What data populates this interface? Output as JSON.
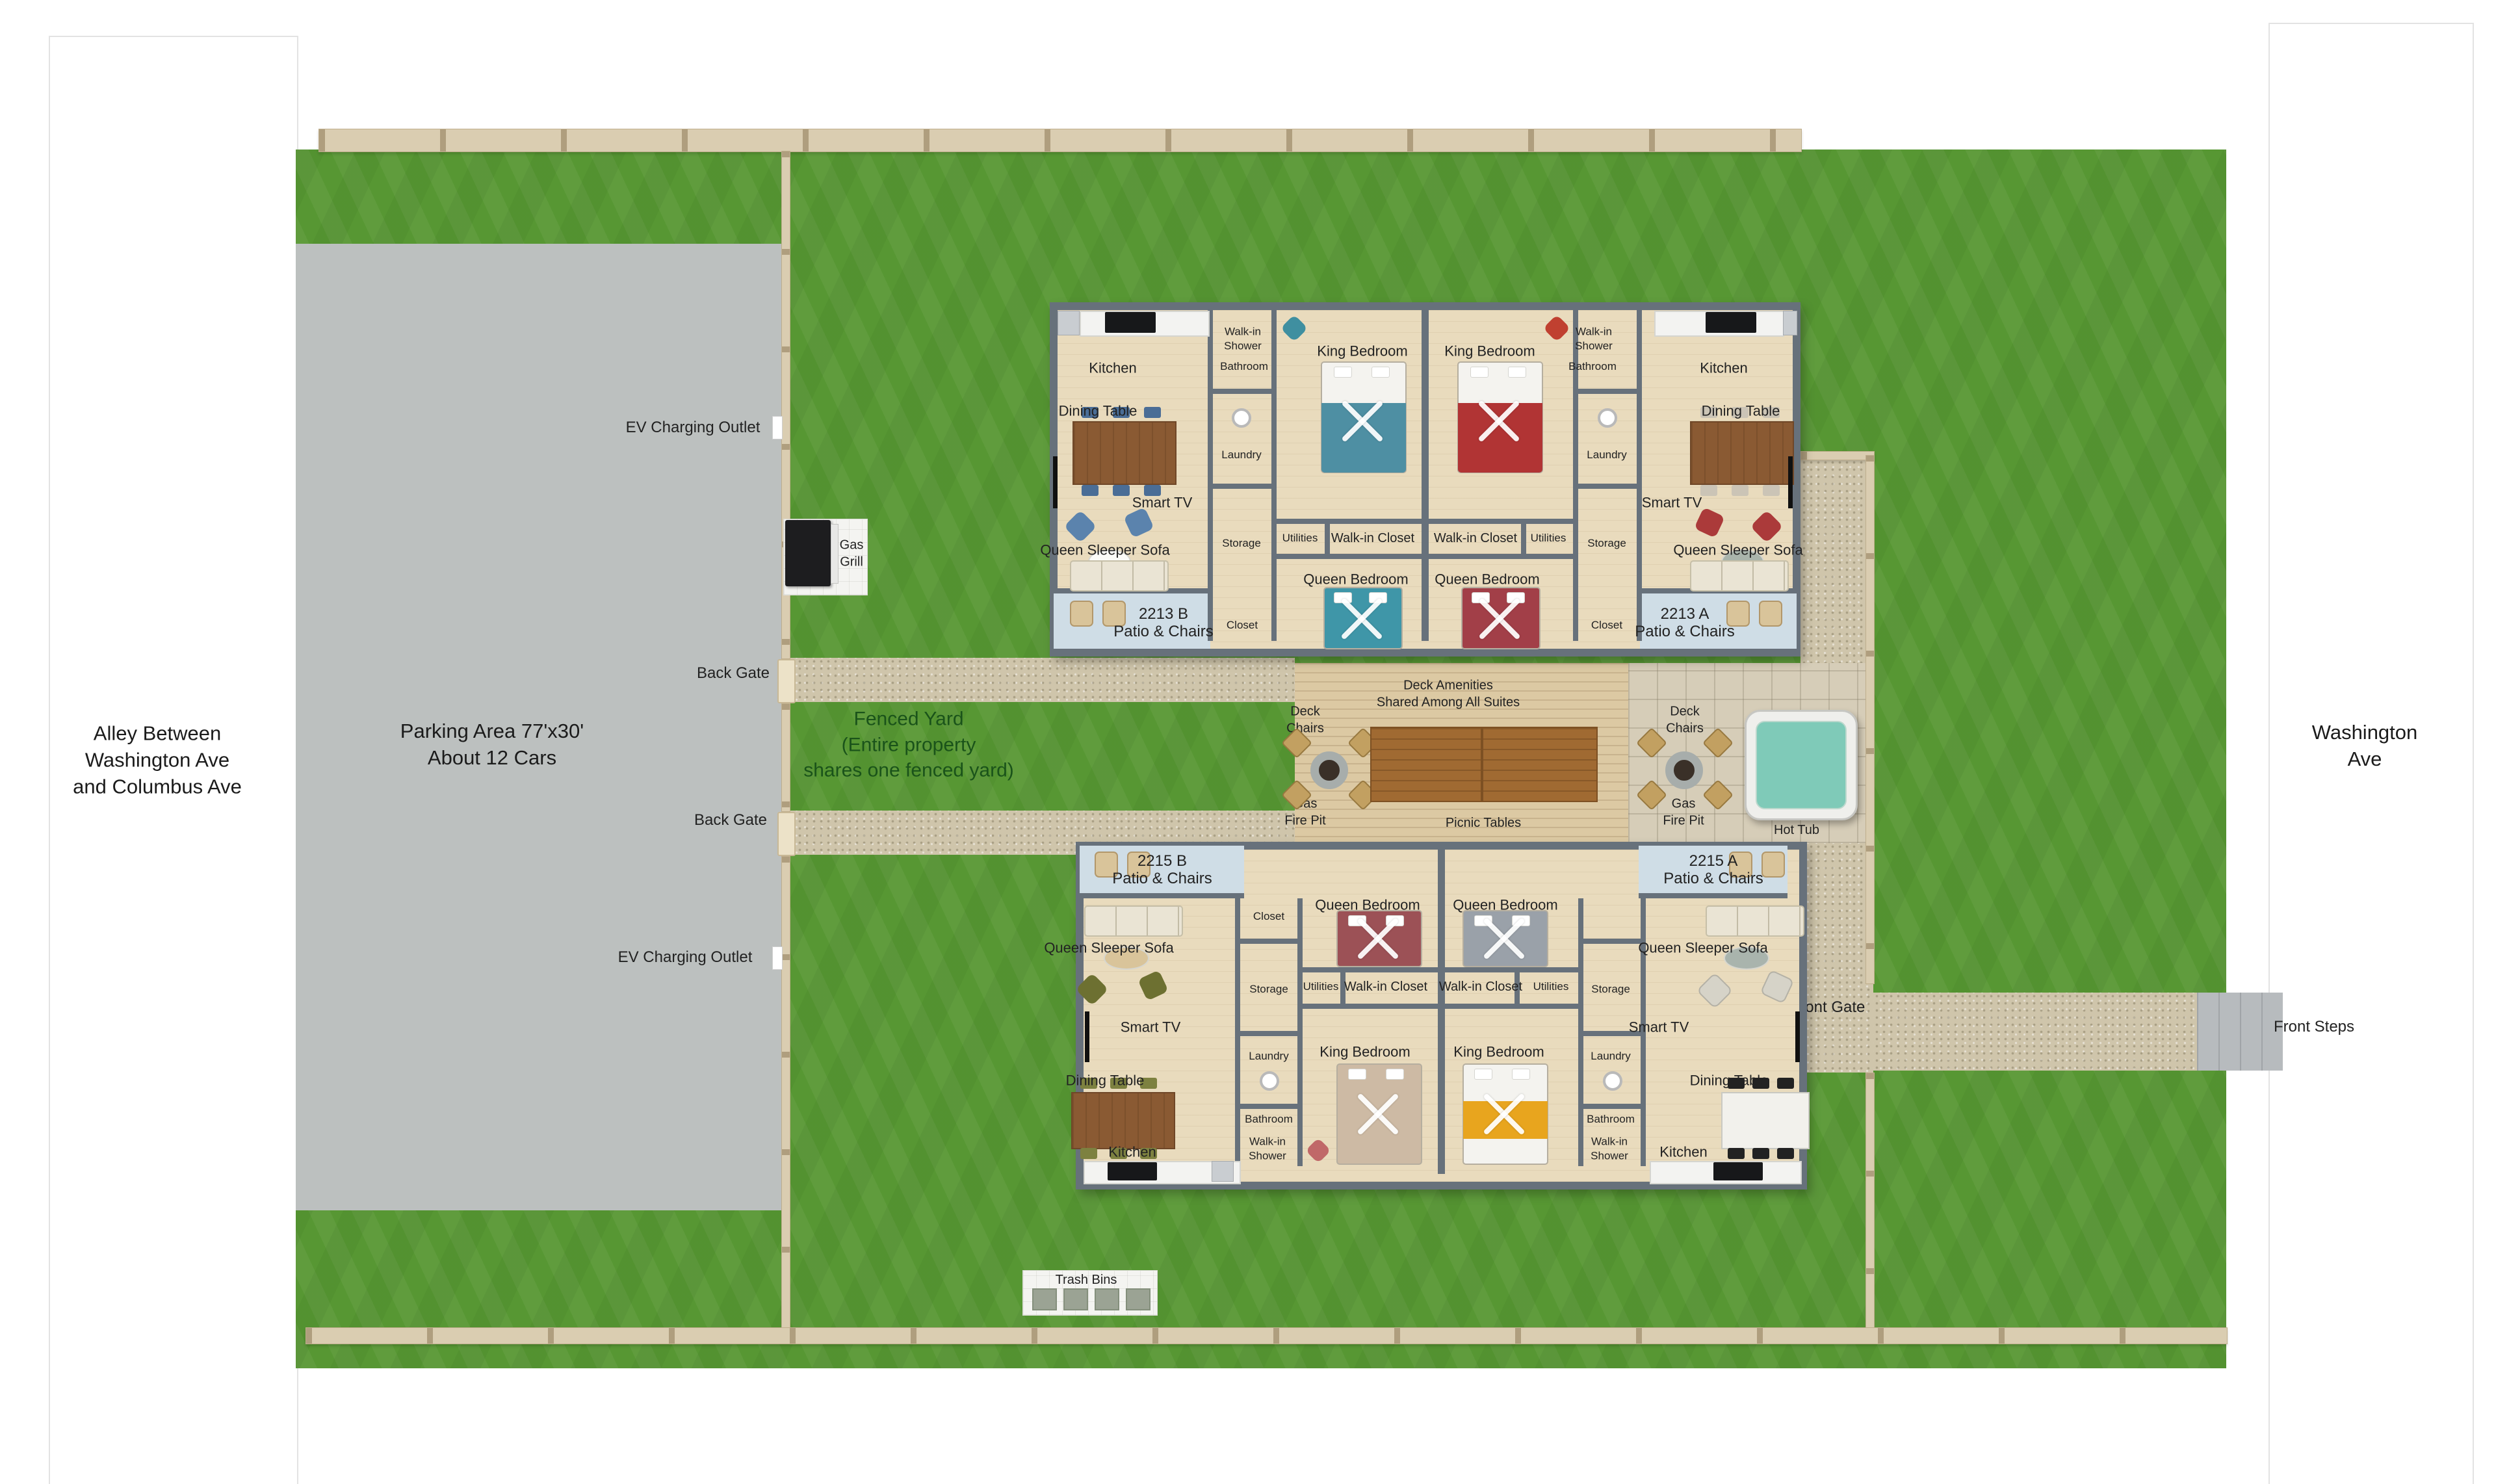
{
  "streets": {
    "alley": "Alley Between\nWashington Ave\nand Columbus Ave",
    "washington": "Washington Ave",
    "front_steps": "Front Steps"
  },
  "parking": {
    "label": "Parking Area 77'x30'\nAbout 12 Cars",
    "ev_outlet": "EV Charging Outlet"
  },
  "yard": {
    "fenced_yard": "Fenced Yard\n(Entire property\nshares one fenced yard)",
    "back_gate": "Back Gate",
    "front_gate": "Front Gate",
    "gas_grill": "Gas\nGrill",
    "trash_bins": "Trash Bins"
  },
  "deck": {
    "amenities": "Deck Amenities\nShared Among All Suites",
    "deck_chairs": "Deck\nChairs",
    "gas_fire_pit": "Gas\nFire Pit",
    "picnic_tables": "Picnic Tables",
    "hot_tub": "Hot Tub"
  },
  "rooms": {
    "kitchen": "Kitchen",
    "dining_table": "Dining Table",
    "smart_tv": "Smart TV",
    "queen_sleeper_sofa": "Queen Sleeper Sofa",
    "walk_in_shower": "Walk-in\nShower",
    "bathroom": "Bathroom",
    "laundry": "Laundry",
    "storage": "Storage",
    "utilities": "Utilities",
    "walk_in_closet": "Walk-in Closet",
    "king_bedroom": "King Bedroom",
    "queen_bedroom": "Queen Bedroom",
    "closet": "Closet",
    "patio_chairs": "Patio & Chairs"
  },
  "units": {
    "b2213": "2213 B",
    "a2213": "2213 A",
    "b2215": "2215 B",
    "a2215": "2215 A"
  },
  "colors": {
    "grass": "#579733",
    "parking": "#bcc0bf",
    "fence": "#dacdb1",
    "wall": "#67717b",
    "floor": "#e9dbbd",
    "patio": "#cfdde6",
    "deck_wood": "#dcc9a3",
    "stone": "#d6cdb8",
    "gravel": "#cfc5ab",
    "hot_tub": "#7fcab8",
    "fenced_yard_text": "#1a531a"
  }
}
